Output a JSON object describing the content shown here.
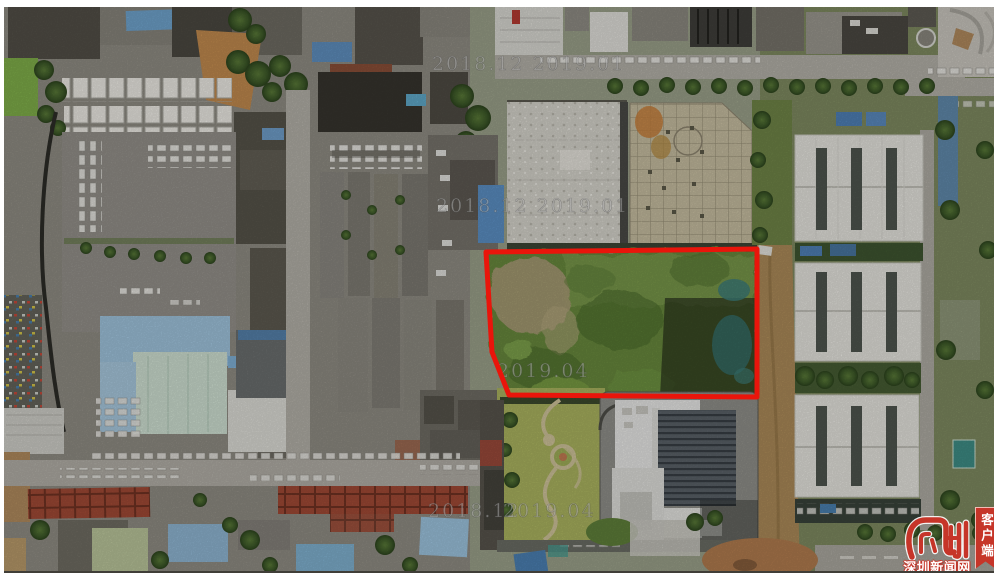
{
  "annotation": {
    "label": "land-plot-outline",
    "color": "#e9150b",
    "polygon_points": "486,252 757,249 757,397 509,395 492,352"
  },
  "watermarks": [
    {
      "text": "2018.12 2019.01"
    },
    {
      "text": "2018.12 2019.01"
    },
    {
      "text": "2019.04"
    },
    {
      "text": "2018.12"
    },
    {
      "text": "2019.04"
    }
  ],
  "logo": {
    "site_name": "深圳新闻网",
    "ribbon_label": "客户端",
    "brand_color": "#c63529"
  }
}
